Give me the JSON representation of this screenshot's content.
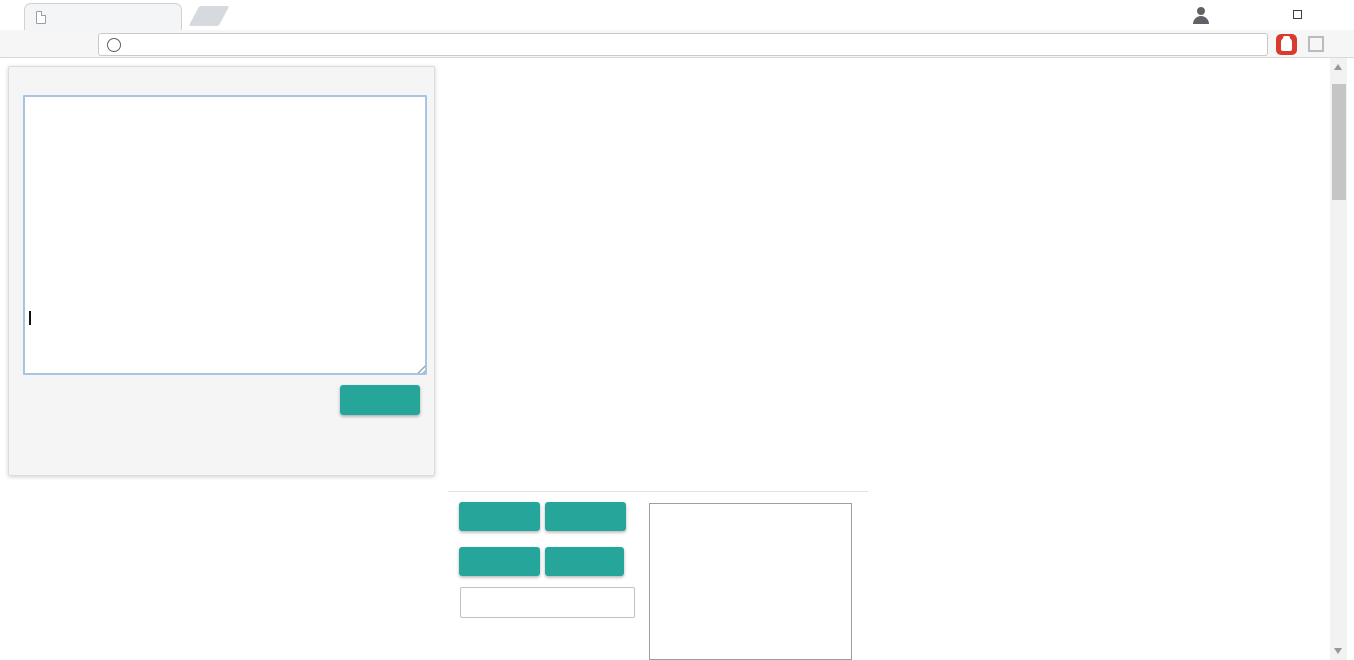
{
  "browser": {
    "tab_title": "127.0.0.1:1055/drawMa",
    "tab_close": "×",
    "url": "127.0.0.1:1055/drawMapGUI.html",
    "info_glyph": "i",
    "back": "←",
    "forward": "→",
    "reload": "⟳",
    "star": "☆",
    "check": "✓",
    "menu": "⋮",
    "minimize": "—",
    "close": "✕"
  },
  "panel": {
    "col_headers": [
      0,
      1,
      2,
      3,
      4,
      5,
      6,
      7,
      8,
      9,
      10,
      11,
      12
    ],
    "row_headers": [
      0,
      1,
      2,
      3,
      4,
      5,
      6,
      7,
      8,
      9,
      10,
      11,
      12
    ],
    "error_message": "发生错误！ SyntaxError: Unexpected token ] position 14",
    "copymap": "COPYMAP"
  },
  "controls": {
    "clearmap": "CLEARMAP",
    "exportmap": "EXPORTMAP",
    "read": "READ",
    "write": "WRITE",
    "filename_placeholder": "请输入文件名"
  },
  "colors": {
    "accent_teal": "#26a69a",
    "error_red": "#c00000",
    "header_blue": "#2a2ac8",
    "rowlabel_red": "#cc2a2a"
  },
  "map": {
    "tile_size": 32,
    "grid": [
      [
        29,
        0,
        29,
        0,
        27,
        3,
        204,
        3,
        32,
        0,
        206,
        0,
        28
      ],
      [
        209,
        3,
        3,
        206,
        81,
        34,
        203,
        28,
        221,
        27,
        0,
        3,
        47
      ],
      [
        0,
        31,
        0,
        217,
        0,
        202,
        0,
        3,
        0,
        3,
        82,
        0,
        205
      ],
      [
        221,
        3,
        3,
        32,
        3,
        3,
        202,
        0,
        33,
        3,
        0,
        3,
        31
      ],
      [
        0,
        81,
        27,
        3,
        47,
        203,
        0,
        3,
        203,
        28,
        202,
        81,
        28
      ],
      [
        21,
        3,
        215,
        32,
        0,
        27,
        205,
        3,
        0,
        3,
        0,
        3,
        3
      ],
      [
        206,
        3,
        3,
        0,
        82,
        3,
        34,
        81,
        29,
        0,
        0,
        209,
        21
      ],
      [
        0,
        3,
        28,
        221,
        31,
        3,
        0,
        3,
        3,
        221,
        3,
        3,
        0
      ],
      [
        27,
        3,
        3,
        3,
        201,
        3,
        201,
        3,
        33,
        0,
        28,
        3,
        33
      ],
      [
        0,
        202,
        0,
        27,
        0,
        201,
        0,
        3,
        3,
        82,
        3,
        0,
        0
      ],
      [
        3,
        22,
        3,
        3,
        3,
        3,
        47,
        0,
        215,
        0,
        0,
        3,
        202
      ],
      [
        27,
        3,
        0,
        81,
        0,
        45,
        0,
        21,
        3,
        215,
        81,
        34,
        0
      ],
      [
        34,
        217,
        29,
        0,
        205,
        3,
        0,
        3,
        65,
        27,
        0,
        3,
        29
      ]
    ],
    "tile_legend": {
      "0": "dark-floor",
      "3": "lavender-brick-wall",
      "21": "gold-key",
      "22": "silver-key",
      "27": "red-gem",
      "28": "violet-gem",
      "29": "green-gem",
      "31": "red-potion",
      "32": "silver-potion",
      "33": "green-potion",
      "34": "yellow-potion",
      "45": "question-book",
      "47": "pickaxe",
      "65": "magic-orb",
      "81": "tan-door",
      "82": "lavender-door",
      "201": "mint-ball-monster",
      "202": "red-ball-monster",
      "203": "dark-ball-monster",
      "204": "green-slime",
      "205": "small-bat",
      "206": "big-bat",
      "209": "skeleton",
      "215": "stone-face",
      "217": "hooded-ghost",
      "221": "stone-golem"
    }
  },
  "palette": {
    "items": [
      [
        "cobble",
        0,
        0
      ],
      [
        "brownbrick",
        0,
        1
      ],
      [
        "graystone",
        0,
        2
      ],
      [
        "lavbrick",
        0,
        3
      ],
      [
        "starfield",
        0,
        4
      ],
      [
        "redground",
        0,
        5
      ],
      [
        "diagstripe",
        0,
        6
      ],
      [
        "meter",
        0,
        7
      ],
      [
        "stairs",
        0,
        8
      ],
      [
        "tandoor",
        0,
        9
      ],
      [
        "lavdoor",
        0,
        10
      ],
      [
        "reddoor",
        0,
        11
      ],
      [
        "greendoor",
        0,
        12
      ],
      [
        "lattice",
        0,
        13
      ],
      [
        "pillarrow",
        0,
        14
      ],
      [
        "wingplat",
        0,
        15
      ],
      [
        "wingplat",
        0,
        16
      ],
      [
        "pinkplat",
        0,
        17
      ],
      [
        "starfield",
        1,
        0,
        4,
        1
      ],
      [
        "redground",
        1,
        1,
        4,
        1
      ],
      [
        "water",
        1,
        2,
        4,
        1
      ],
      [
        "tandoor",
        1,
        3
      ],
      [
        "tandoor",
        2,
        3
      ],
      [
        "tandoor",
        3.15,
        3
      ],
      [
        "tandoor",
        4.35,
        3,
        0.62,
        1
      ],
      [
        "lavdoor",
        1,
        4
      ],
      [
        "lavdoor",
        2,
        4
      ],
      [
        "lavdoor",
        3.15,
        4
      ],
      [
        "lavdoor",
        4.35,
        4,
        0.62,
        1
      ],
      [
        "reddoor",
        1,
        5
      ],
      [
        "reddoor",
        2,
        5
      ],
      [
        "reddoor",
        3.15,
        5
      ],
      [
        "reddoor",
        4.35,
        5,
        0.62,
        1
      ],
      [
        "greendoor",
        1,
        6
      ],
      [
        "greendoor",
        2,
        6
      ],
      [
        "greendoor",
        3.15,
        6
      ],
      [
        "greendoor",
        4.35,
        6,
        0.62,
        1
      ],
      [
        "lattice",
        1,
        7
      ],
      [
        "lattice",
        2,
        7
      ],
      [
        "lattice",
        3.15,
        7,
        0.78,
        0.78
      ],
      [
        "lattice",
        4.3,
        7,
        0.5,
        0.5
      ],
      [
        "rubble_lav",
        1,
        8,
        4,
        1
      ],
      [
        "rubble_brown",
        1,
        9,
        4,
        1
      ],
      [
        "rubble_gray",
        1,
        10,
        4,
        1
      ],
      [
        "pillarrow",
        1,
        11,
        2,
        1
      ],
      [
        "pillarrow",
        3.2,
        11,
        1.2,
        0.85
      ],
      [
        "dimin_red",
        1,
        12,
        4,
        1
      ],
      [
        "dimin_gray",
        1,
        13,
        4,
        1
      ],
      [
        "dimin_star",
        1,
        14,
        4,
        1
      ],
      [
        "rubble_lav",
        1,
        15,
        4,
        1
      ],
      [
        "rubble_brown",
        1,
        16,
        4,
        1
      ],
      [
        "rubble_gray",
        1,
        17,
        4,
        1
      ],
      [
        "pinkwall",
        0,
        18,
        4.6,
        1
      ],
      [
        "ballmint",
        5.2,
        0,
        1,
        1,
        1
      ],
      [
        "ballred",
        5.2,
        1,
        1,
        1,
        1
      ],
      [
        "balldark",
        5.2,
        2,
        1,
        1,
        1
      ],
      [
        "crownslime",
        5.2,
        3,
        1,
        1,
        1
      ],
      [
        "batS",
        5.2,
        4,
        1,
        1,
        1
      ],
      [
        "batB",
        5.2,
        5,
        1,
        1,
        1
      ],
      [
        "redbat",
        5.2,
        6,
        1,
        1,
        1
      ],
      [
        "vampire",
        5.2,
        7,
        1,
        1,
        1
      ],
      [
        "skeleton",
        5.2,
        8,
        1,
        1,
        1
      ],
      [
        "skelshield",
        5.2,
        9,
        1,
        1,
        1
      ],
      [
        "skelsword",
        5.2,
        10,
        1,
        1,
        1
      ],
      [
        "skelpurple",
        5.2,
        11,
        1,
        1,
        1
      ],
      [
        "golem",
        5.2,
        12,
        1,
        1,
        1
      ],
      [
        "golemshield",
        5.2,
        13,
        1,
        1,
        1
      ],
      [
        "bigface",
        5.2,
        14,
        1,
        1,
        1
      ],
      [
        "slimeman",
        5.2,
        15,
        1,
        1,
        1
      ],
      [
        "ghostlav",
        5.2,
        16,
        1,
        1,
        1
      ],
      [
        "ghostred",
        5.2,
        17,
        1,
        1,
        1
      ],
      [
        "hatman",
        5.2,
        18,
        1,
        1,
        1
      ],
      [
        "goldkey",
        7.05,
        0
      ],
      [
        "bluekey",
        7.05,
        1
      ],
      [
        "redkey",
        7.05,
        2
      ],
      [
        "greenkey",
        7.05,
        3
      ],
      [
        "graykey",
        7.05,
        4
      ],
      [
        "pinkkey",
        7.05,
        5
      ],
      [
        "coin",
        7.05,
        6
      ],
      [
        "redscroll",
        7.05,
        7
      ],
      [
        "scroll",
        7.05,
        8
      ],
      [
        "book",
        7.05,
        9
      ],
      [
        "staff",
        7.05,
        10
      ],
      [
        "medal",
        7.05,
        11
      ],
      [
        "star6",
        7.3,
        13.7,
        1.35,
        1.35
      ],
      [
        "oldman",
        8.1,
        0,
        1,
        1,
        1
      ],
      [
        "dwarf",
        8.1,
        1,
        1,
        1,
        1
      ],
      [
        "fighter",
        8.1,
        2,
        1,
        1,
        1
      ],
      [
        "fairy",
        8.1,
        3,
        1,
        1,
        1
      ],
      [
        "wizard",
        8.1,
        4,
        1,
        1,
        1
      ],
      [
        "redhood",
        8.1,
        5,
        1,
        1,
        1
      ],
      [
        "monkey",
        8.1,
        6.7,
        1,
        1,
        1
      ],
      [
        "sign",
        8.1,
        7.8,
        1,
        1,
        1
      ],
      [
        "pinkwall",
        8.05,
        8.9,
        2.45,
        1.2
      ],
      [
        "lavwall",
        8.05,
        10.25,
        2.45,
        1.2
      ],
      [
        "bride",
        8.1,
        11.7,
        1,
        1,
        1
      ],
      [
        "wingitem",
        9.25,
        13.1
      ],
      [
        "wingitem",
        9.25,
        14.1
      ],
      [
        "wingitem",
        9.25,
        15.1
      ],
      [
        "gemred",
        9.25,
        16.1
      ],
      [
        "gemviolet",
        9.25,
        17.1
      ],
      [
        "gemgreen",
        9.25,
        18.1
      ],
      [
        "treeD",
        10.1,
        0
      ],
      [
        "treeB",
        12,
        0
      ],
      [
        "treeBig",
        10.15,
        1,
        2.65,
        2.78
      ]
    ]
  }
}
